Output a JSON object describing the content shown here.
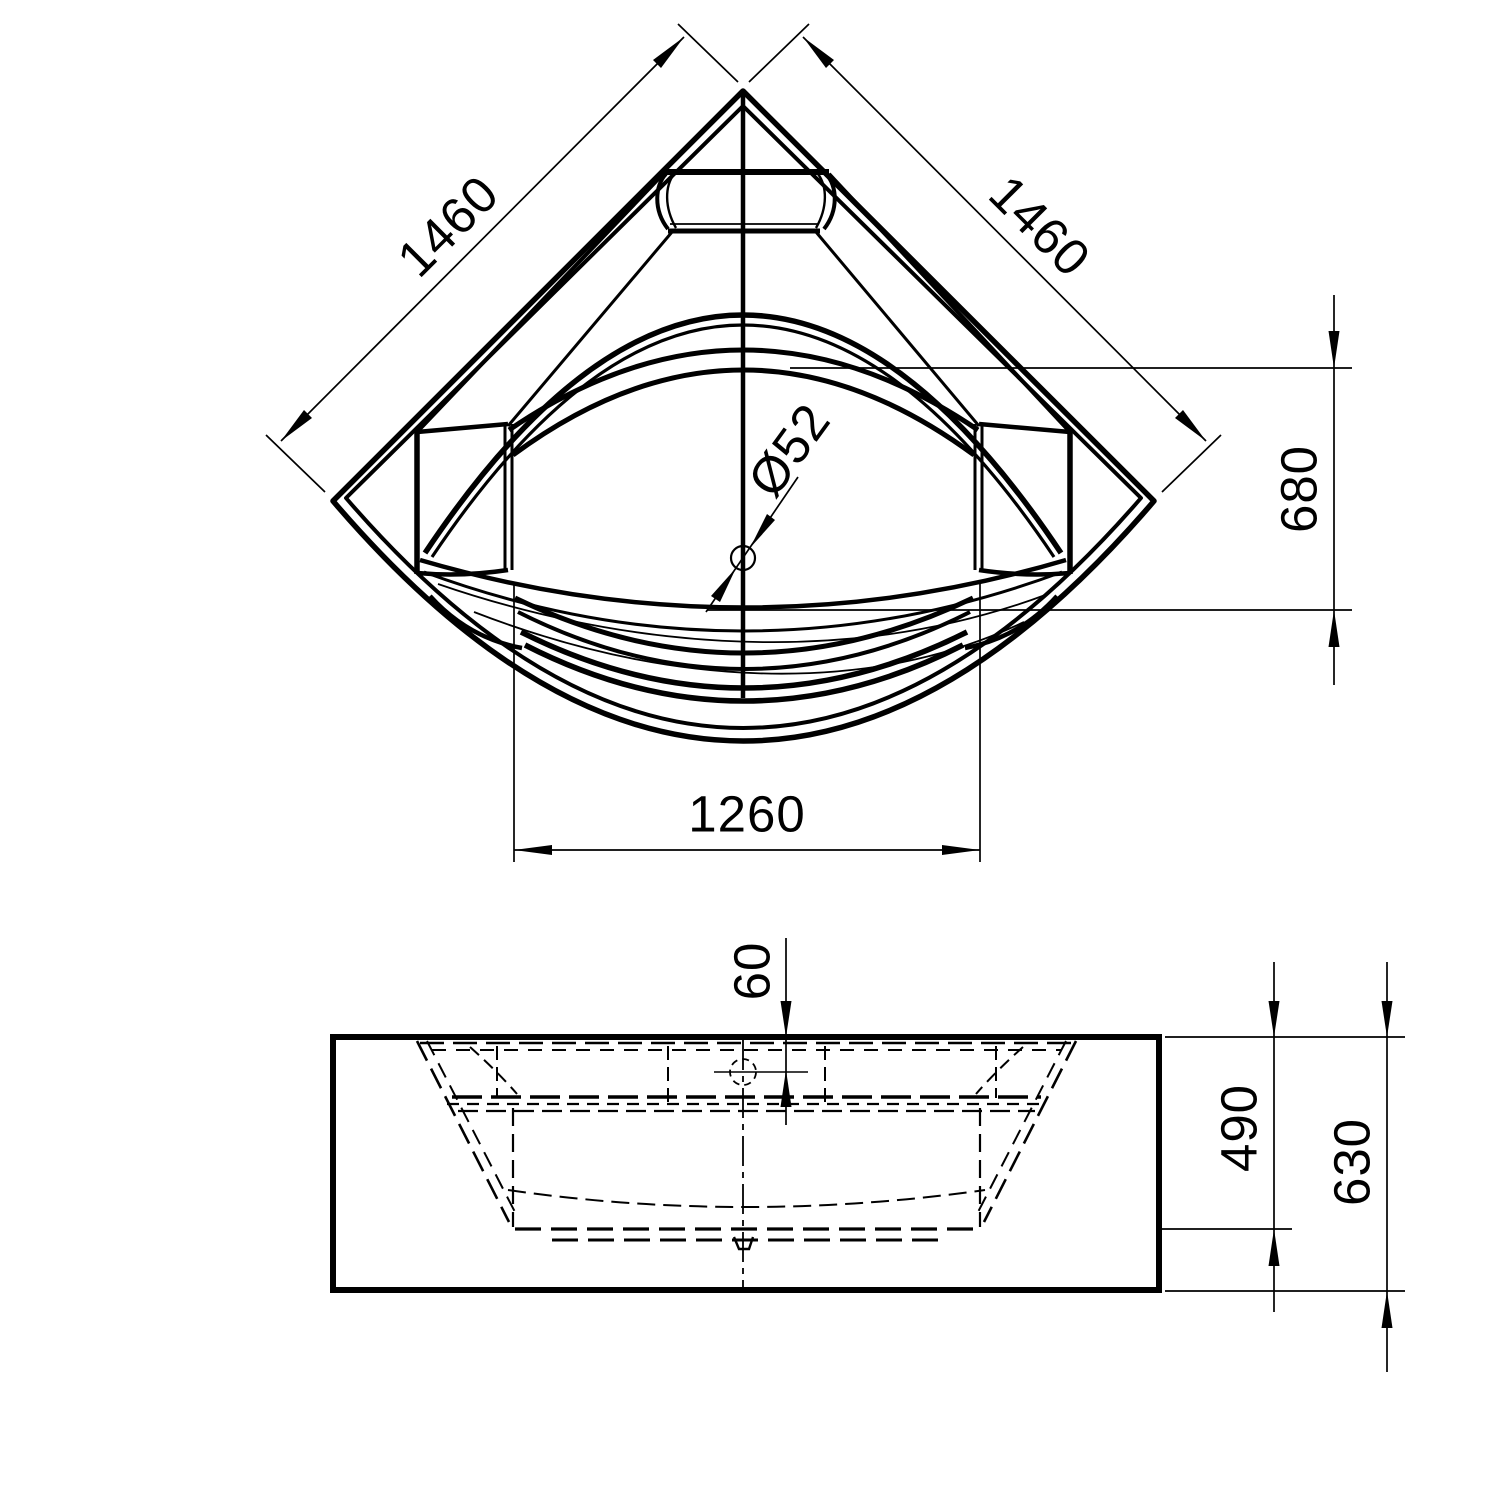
{
  "dimensions": {
    "side_left": "1460",
    "side_right": "1460",
    "basin_depth": "680",
    "front_width": "1260",
    "drain_diameter": "Ø52",
    "rim_offset": "60",
    "inner_height": "490",
    "total_height": "630"
  },
  "colors": {
    "line": "#000000",
    "background": "#ffffff"
  }
}
